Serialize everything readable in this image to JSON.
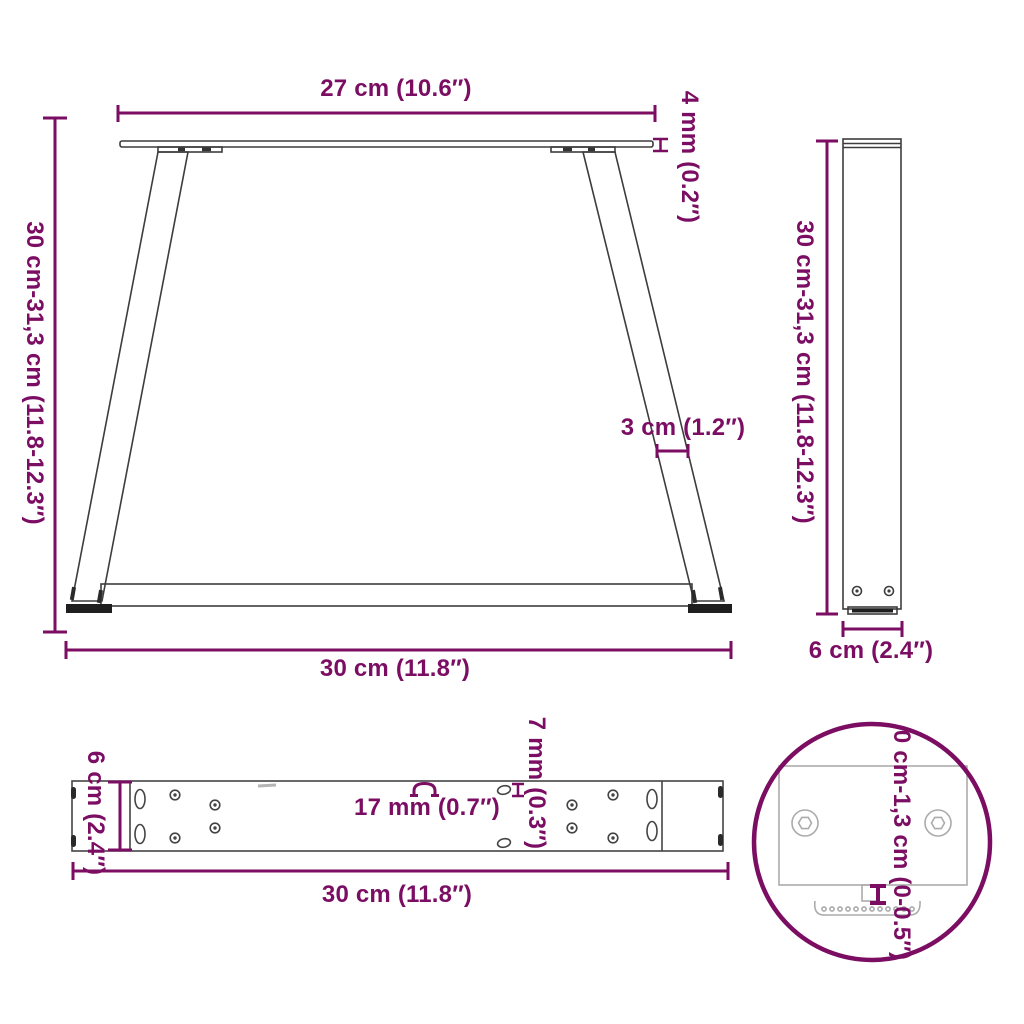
{
  "page": {
    "type": "product-dimension-diagram",
    "background_color": "#ffffff"
  },
  "colors": {
    "dimension_accent": "#7b0d63",
    "drawing_line": "#3d3d3d",
    "drawing_dark_fill": "#1f1f1f",
    "detail_line": "#ababab"
  },
  "diagram": {
    "front_view": {
      "top_width_label": "27 cm (10.6″)",
      "top_plate_thickness_label": "4 mm (0.2″)",
      "height_label": "30 cm-31,3 cm (11.8-12.3″)",
      "leg_profile_width_label": "3 cm (1.2″)",
      "bottom_width_label": "30 cm (11.8″)"
    },
    "side_view": {
      "height_label": "30 cm-31,3 cm (11.8-12.3″)",
      "depth_label": "6 cm (2.4″)"
    },
    "top_view": {
      "depth_label": "6 cm (2.4″)",
      "slot_width_label": "17 mm (0.7″)",
      "hole_diameter_label": "7 mm (0.3″)",
      "length_label": "30 cm (11.8″)"
    },
    "detail_view": {
      "height_adjustment_label": "0 cm-1,3 cm (0-0.5″)"
    }
  }
}
